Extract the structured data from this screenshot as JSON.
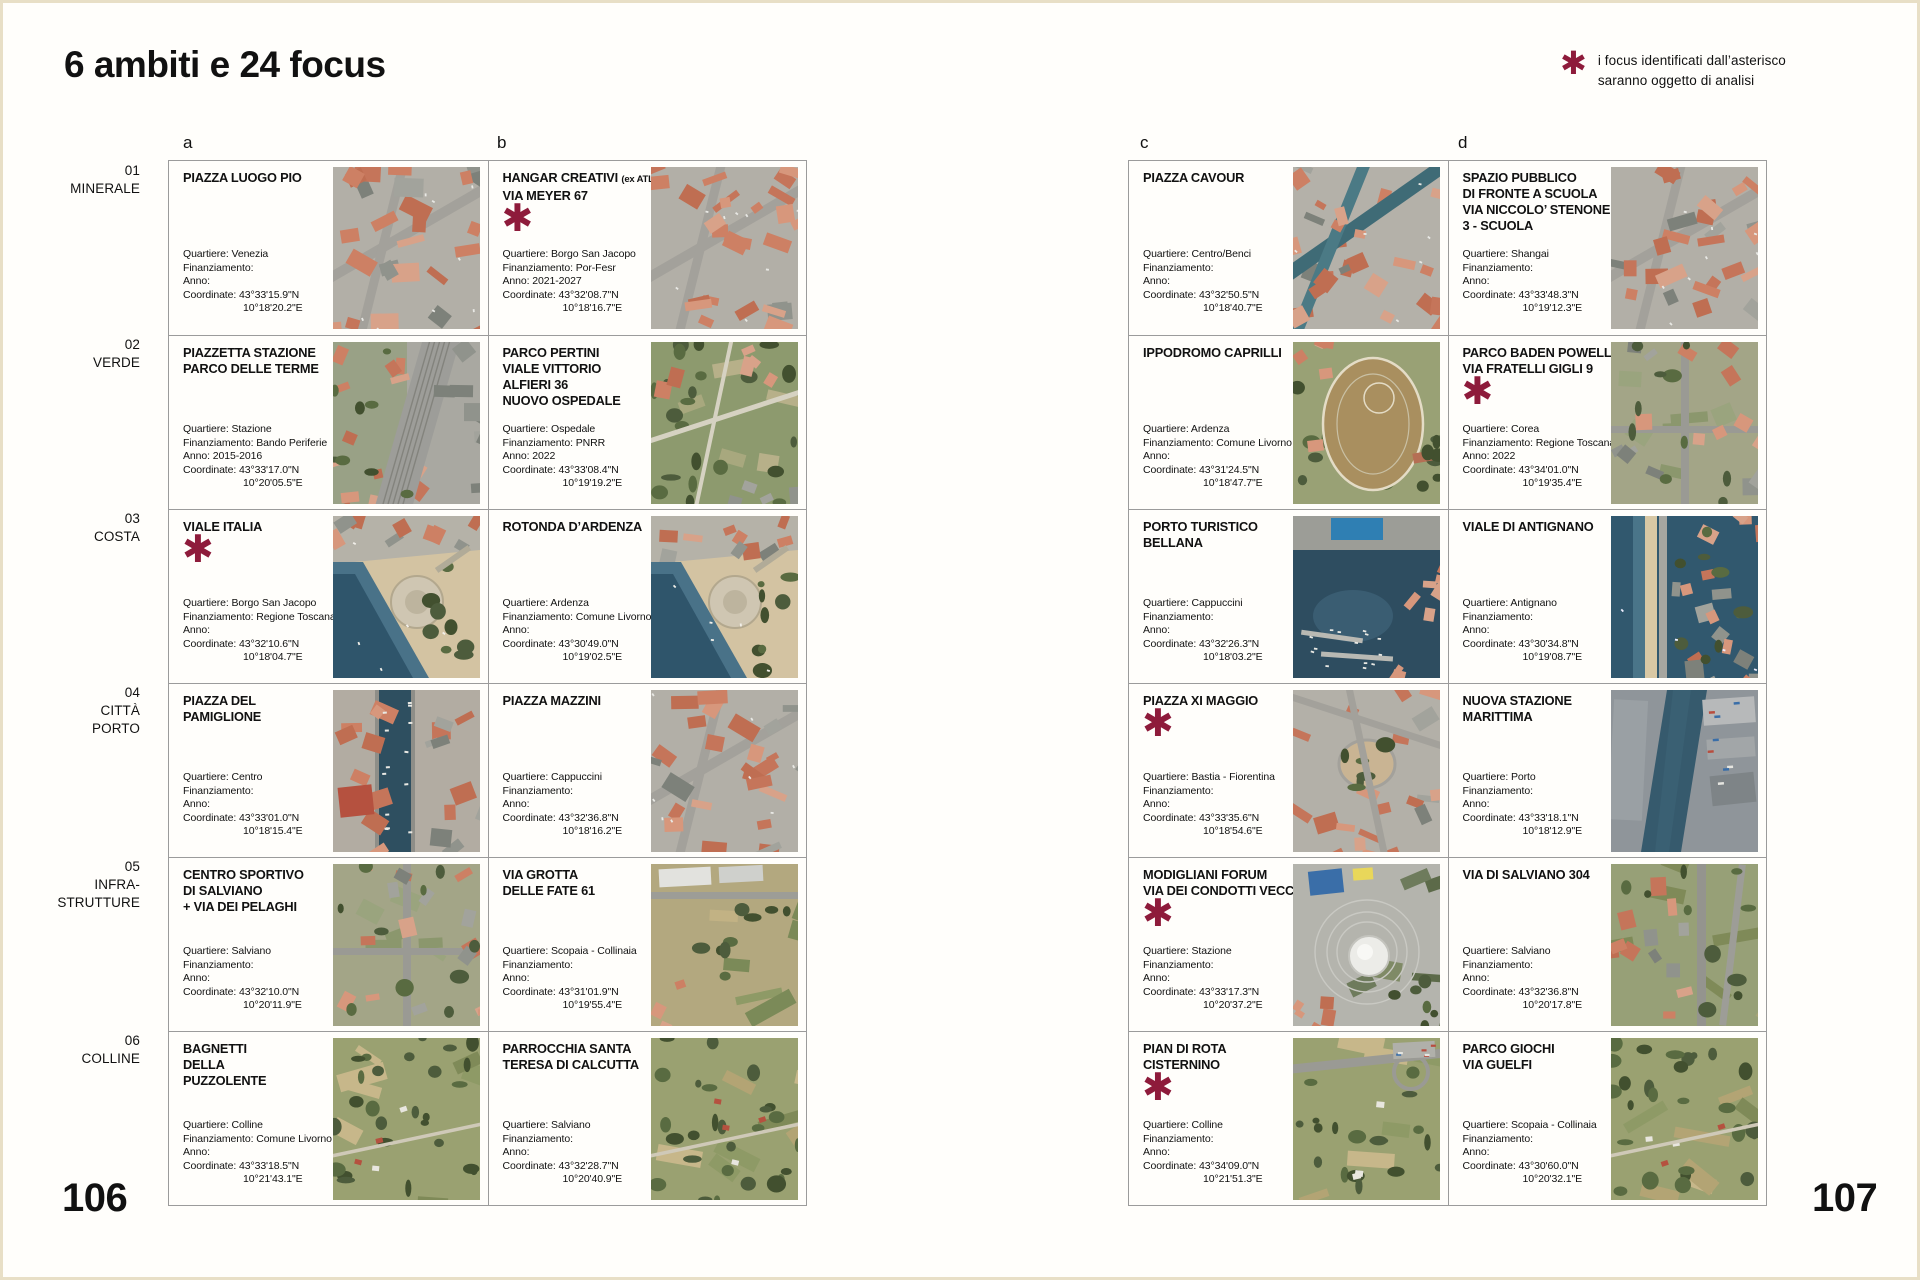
{
  "page": {
    "title": "6 ambiti e 24 focus",
    "legend": {
      "symbol": "✱",
      "line1": "i focus identificati dall’asterisco",
      "line2": "saranno oggetto di analisi"
    },
    "page_number_left": "106",
    "page_number_right": "107",
    "column_letters": [
      "a",
      "b",
      "c",
      "d"
    ],
    "accent_color": "#8e1b3b",
    "detail_labels": {
      "quartiere": "Quartiere:",
      "finanziamento": "Finanziamento:",
      "anno": "Anno:",
      "coordinate": "Coordinate:"
    }
  },
  "ambiti": [
    {
      "num": "01",
      "name_lines": [
        "MINERALE"
      ]
    },
    {
      "num": "02",
      "name_lines": [
        "VERDE"
      ]
    },
    {
      "num": "03",
      "name_lines": [
        "COSTA"
      ]
    },
    {
      "num": "04",
      "name_lines": [
        "CITTÀ",
        "PORTO"
      ]
    },
    {
      "num": "05",
      "name_lines": [
        "INFRA-",
        "STRUTTURE"
      ]
    },
    {
      "num": "06",
      "name_lines": [
        "COLLINE"
      ]
    }
  ],
  "focuses": [
    {
      "row": 1,
      "col": "a",
      "title_lines": [
        "PIAZZA LUOGO PIO"
      ],
      "asterisk": false,
      "quartiere": "Venezia",
      "finanziamento": "",
      "anno": "",
      "coord_n": "43°33'15.9\"N",
      "coord_e": "10°18'20.2\"E",
      "image_theme": "urban"
    },
    {
      "row": 1,
      "col": "b",
      "title_lines": [
        "HANGAR CREATIVI (ex ATL)",
        "VIA MEYER 67"
      ],
      "asterisk": true,
      "quartiere": "Borgo San Jacopo",
      "finanziamento": "Por-Fesr",
      "anno": "2021-2027",
      "coord_n": "43°32'08.7\"N",
      "coord_e": "10°18'16.7\"E",
      "image_theme": "urban"
    },
    {
      "row": 1,
      "col": "c",
      "title_lines": [
        "PIAZZA CAVOUR"
      ],
      "asterisk": false,
      "quartiere": "Centro/Benci",
      "finanziamento": "",
      "anno": "",
      "coord_n": "43°32'50.5\"N",
      "coord_e": "10°18'40.7\"E",
      "image_theme": "canal"
    },
    {
      "row": 1,
      "col": "d",
      "title_lines": [
        "SPAZIO PUBBLICO",
        "DI FRONTE A SCUOLA",
        "VIA NICCOLO’ STENONE",
        "3 - SCUOLA"
      ],
      "asterisk": false,
      "quartiere": "Shangai",
      "finanziamento": "",
      "anno": "",
      "coord_n": "43°33'48.3\"N",
      "coord_e": "10°19'12.3\"E",
      "image_theme": "urban"
    },
    {
      "row": 2,
      "col": "a",
      "title_lines": [
        "PIAZZETTA STAZIONE",
        "PARCO DELLE TERME"
      ],
      "asterisk": false,
      "quartiere": "Stazione",
      "finanziamento": "Bando Periferie",
      "anno": "2015-2016",
      "coord_n": "43°33'17.0\"N",
      "coord_e": "10°20'05.5\"E",
      "image_theme": "rail"
    },
    {
      "row": 2,
      "col": "b",
      "title_lines": [
        "PARCO PERTINI",
        "VIALE VITTORIO",
        "ALFIERI 36",
        "NUOVO OSPEDALE"
      ],
      "asterisk": false,
      "quartiere": "Ospedale",
      "finanziamento": "PNRR",
      "anno": "2022",
      "coord_n": "43°33'08.4\"N",
      "coord_e": "10°19'19.2\"E",
      "image_theme": "park"
    },
    {
      "row": 2,
      "col": "c",
      "title_lines": [
        "IPPODROMO CAPRILLI"
      ],
      "asterisk": false,
      "quartiere": "Ardenza",
      "finanziamento": "Comune Livorno",
      "anno": "",
      "coord_n": "43°31'24.5\"N",
      "coord_e": "10°18'47.7\"E",
      "image_theme": "track"
    },
    {
      "row": 2,
      "col": "d",
      "title_lines": [
        "PARCO BADEN POWELL",
        "VIA FRATELLI GIGLI 9"
      ],
      "asterisk": true,
      "quartiere": "Corea",
      "finanziamento": "Regione Toscana",
      "anno": "2022",
      "coord_n": "43°34'01.0\"N",
      "coord_e": "10°19'35.4\"E",
      "image_theme": "suburb"
    },
    {
      "row": 3,
      "col": "a",
      "title_lines": [
        "VIALE ITALIA"
      ],
      "asterisk": true,
      "quartiere": "Borgo San Jacopo",
      "finanziamento": "Regione Toscana",
      "anno": "",
      "coord_n": "43°32'10.6\"N",
      "coord_e": "10°18'04.7\"E",
      "image_theme": "coast"
    },
    {
      "row": 3,
      "col": "b",
      "title_lines": [
        "ROTONDA D’ARDENZA"
      ],
      "asterisk": false,
      "quartiere": "Ardenza",
      "finanziamento": "Comune Livorno",
      "anno": "",
      "coord_n": "43°30'49.0\"N",
      "coord_e": "10°19'02.5\"E",
      "image_theme": "coast"
    },
    {
      "row": 3,
      "col": "c",
      "title_lines": [
        "PORTO TURISTICO",
        "BELLANA"
      ],
      "asterisk": false,
      "quartiere": "Cappuccini",
      "finanziamento": "",
      "anno": "",
      "coord_n": "43°32'26.3\"N",
      "coord_e": "10°18'03.2\"E",
      "image_theme": "harbor"
    },
    {
      "row": 3,
      "col": "d",
      "title_lines": [
        "VIALE DI ANTIGNANO"
      ],
      "asterisk": false,
      "quartiere": "Antignano",
      "finanziamento": "",
      "anno": "",
      "coord_n": "43°30'34.8\"N",
      "coord_e": "10°19'08.7\"E",
      "image_theme": "coastedge"
    },
    {
      "row": 4,
      "col": "a",
      "title_lines": [
        "PIAZZA DEL",
        "PAMIGLIONE"
      ],
      "asterisk": false,
      "quartiere": "Centro",
      "finanziamento": "",
      "anno": "",
      "coord_n": "43°33'01.0\"N",
      "coord_e": "10°18'15.4\"E",
      "image_theme": "canalport"
    },
    {
      "row": 4,
      "col": "b",
      "title_lines": [
        "PIAZZA MAZZINI"
      ],
      "asterisk": false,
      "quartiere": "Cappuccini",
      "finanziamento": "",
      "anno": "",
      "coord_n": "43°32'36.8\"N",
      "coord_e": "10°18'16.2\"E",
      "image_theme": "urban"
    },
    {
      "row": 4,
      "col": "c",
      "title_lines": [
        "PIAZZA XI MAGGIO"
      ],
      "asterisk": true,
      "quartiere": "Bastia - Fiorentina",
      "finanziamento": "",
      "anno": "",
      "coord_n": "43°33'35.6\"N",
      "coord_e": "10°18'54.6\"E",
      "image_theme": "plaza"
    },
    {
      "row": 4,
      "col": "d",
      "title_lines": [
        "NUOVA STAZIONE",
        "MARITTIMA"
      ],
      "asterisk": false,
      "quartiere": "Porto",
      "finanziamento": "",
      "anno": "",
      "coord_n": "43°33'18.1\"N",
      "coord_e": "10°18'12.9\"E",
      "image_theme": "port"
    },
    {
      "row": 5,
      "col": "a",
      "title_lines": [
        "CENTRO SPORTIVO",
        "DI SALVIANO",
        "+ VIA DEI PELAGHI"
      ],
      "asterisk": false,
      "quartiere": "Salviano",
      "finanziamento": "",
      "anno": "",
      "coord_n": "43°32'10.0\"N",
      "coord_e": "10°20'11.9\"E",
      "image_theme": "suburb"
    },
    {
      "row": 5,
      "col": "b",
      "title_lines": [
        "VIA GROTTA",
        "DELLE FATE 61"
      ],
      "asterisk": false,
      "quartiere": "Scopaia - Collinaia",
      "finanziamento": "",
      "anno": "",
      "coord_n": "43°31'01.9\"N",
      "coord_e": "10°19'55.4\"E",
      "image_theme": "fieldsind"
    },
    {
      "row": 5,
      "col": "c",
      "title_lines": [
        "MODIGLIANI FORUM",
        "VIA DEI CONDOTTI VECCHI"
      ],
      "asterisk": true,
      "quartiere": "Stazione",
      "finanziamento": "",
      "anno": "",
      "coord_n": "43°33'17.3\"N",
      "coord_e": "10°20'37.2\"E",
      "image_theme": "arena"
    },
    {
      "row": 5,
      "col": "d",
      "title_lines": [
        "VIA DI SALVIANO 304"
      ],
      "asterisk": false,
      "quartiere": "Salviano",
      "finanziamento": "",
      "anno": "",
      "coord_n": "43°32'36.8\"N",
      "coord_e": "10°20'17.8\"E",
      "image_theme": "roadgreen"
    },
    {
      "row": 6,
      "col": "a",
      "title_lines": [
        "BAGNETTI",
        "DELLA",
        "PUZZOLENTE"
      ],
      "asterisk": false,
      "quartiere": "Colline",
      "finanziamento": "Comune Livorno",
      "anno": "",
      "coord_n": "43°33'18.5\"N",
      "coord_e": "10°21'43.1\"E",
      "image_theme": "rural"
    },
    {
      "row": 6,
      "col": "b",
      "title_lines": [
        "PARROCCHIA SANTA",
        "TERESA DI CALCUTTA"
      ],
      "asterisk": false,
      "quartiere": "Salviano",
      "finanziamento": "",
      "anno": "",
      "coord_n": "43°32'28.7\"N",
      "coord_e": "10°20'40.9\"E",
      "image_theme": "rural"
    },
    {
      "row": 6,
      "col": "c",
      "title_lines": [
        "PIAN DI ROTA",
        "CISTERNINO"
      ],
      "asterisk": true,
      "quartiere": "Colline",
      "finanziamento": "",
      "anno": "",
      "coord_n": "43°34'09.0\"N",
      "coord_e": "10°21'51.3\"E",
      "image_theme": "ruralroad"
    },
    {
      "row": 6,
      "col": "d",
      "title_lines": [
        "PARCO GIOCHI",
        "VIA GUELFI"
      ],
      "asterisk": false,
      "quartiere": "Scopaia - Collinaia",
      "finanziamento": "",
      "anno": "",
      "coord_n": "43°30'60.0\"N",
      "coord_e": "10°20'32.1\"E",
      "image_theme": "rural"
    }
  ]
}
